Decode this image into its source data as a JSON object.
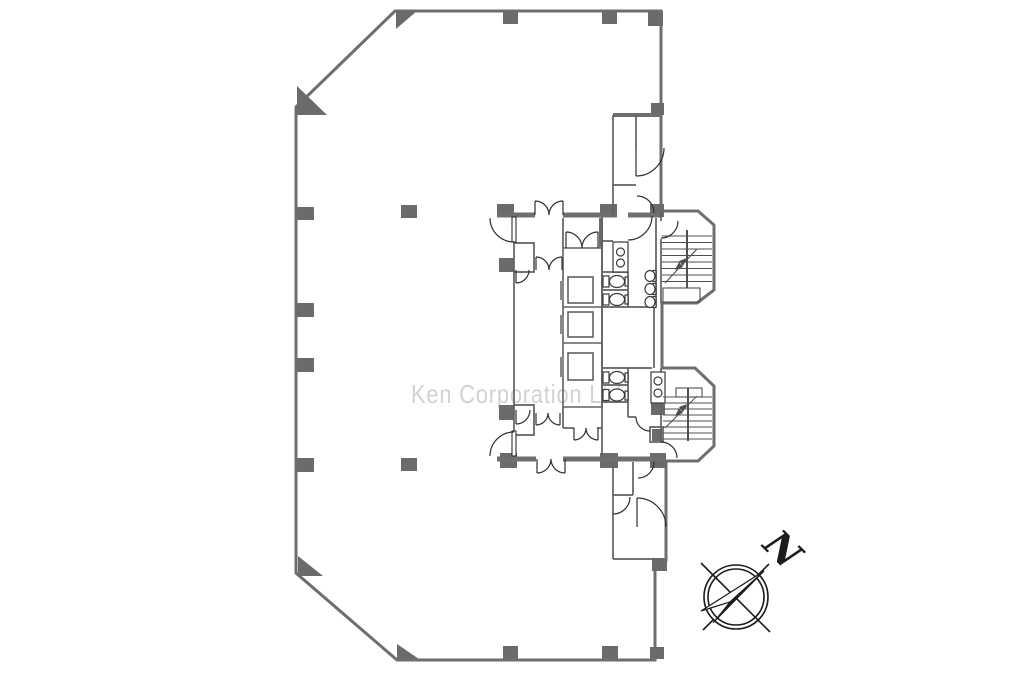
{
  "watermark": {
    "text": "Ken Corporation Ltd."
  },
  "compass": {
    "label": "N"
  },
  "colors": {
    "background": "#ffffff",
    "wall": "#6e6e6e",
    "column": "#6b6b6b",
    "thin_wall": "#606060",
    "fixture": "#3a3a3a",
    "stair": "#4f4f4f",
    "door": "#2f2f2f",
    "elevator_door": "#8a8a8a",
    "compass_ink": "#1c1c1c",
    "watermark_gray": "#d2d2d2"
  },
  "plan": {
    "kind": "building floor plan",
    "elevators": 3,
    "staircases": 2,
    "restrooms": 2
  }
}
